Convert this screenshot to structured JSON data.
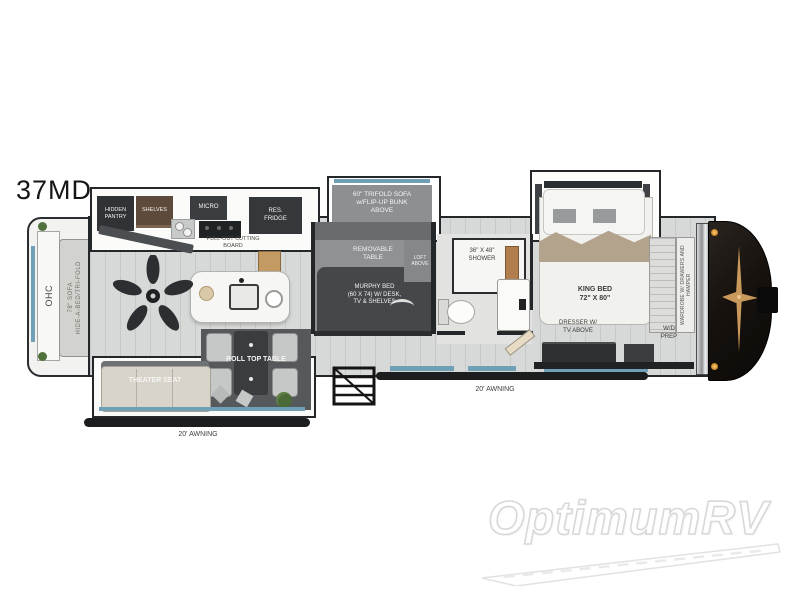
{
  "model": "37MD",
  "watermark": "OptimumRV",
  "labels": {
    "hidden_pantry": "HIDDEN\nPANTRY",
    "shelves": "SHELVES",
    "micro": "MICRO",
    "res_fridge": "RES.\nFRIDGE",
    "pull_out_cutting_board": "PULL-OUT CUTTING\nBOARD",
    "trifold_sofa": "60\" TRIFOLD SOFA\nw/FLIP-UP BUNK\nABOVE",
    "removable_table": "REMOVABLE\nTABLE",
    "loft_above": "LOFT\nABOVE",
    "murphy_bed": "MURPHY BED\n(60 X 74) W/ DESK,\nTV & SHELVES",
    "shower": "36\" X 48\"\nSHOWER",
    "king_bed": "KING BED\n72\" X 80\"",
    "dresser": "DRESSER W/\nTV ABOVE",
    "wd_prep": "W/D\nPREP",
    "wardrobe": "WARDROBE W/ DRAWERS AND HAMPER",
    "ohc": "OHC",
    "rear_sofa": "78\" SOFA\nHIDE-A-BED/TRI-FOLD",
    "theater_seat": "THEATER SEAT",
    "roll_top_table": "ROLL TOP TABLE",
    "awning_rear_side": "20' AWNING",
    "awning_door_side": "20' AWNING"
  },
  "colors": {
    "floor": "#d7d9d8",
    "wall": "#24272a",
    "cabinet": "#33373a",
    "slide_gray": "#8c9092",
    "window_blue": "#6fa0b5",
    "front_cap": "#17120e",
    "emblem_gold": "#c9995c",
    "blanket_tan": "#b3a38c"
  }
}
